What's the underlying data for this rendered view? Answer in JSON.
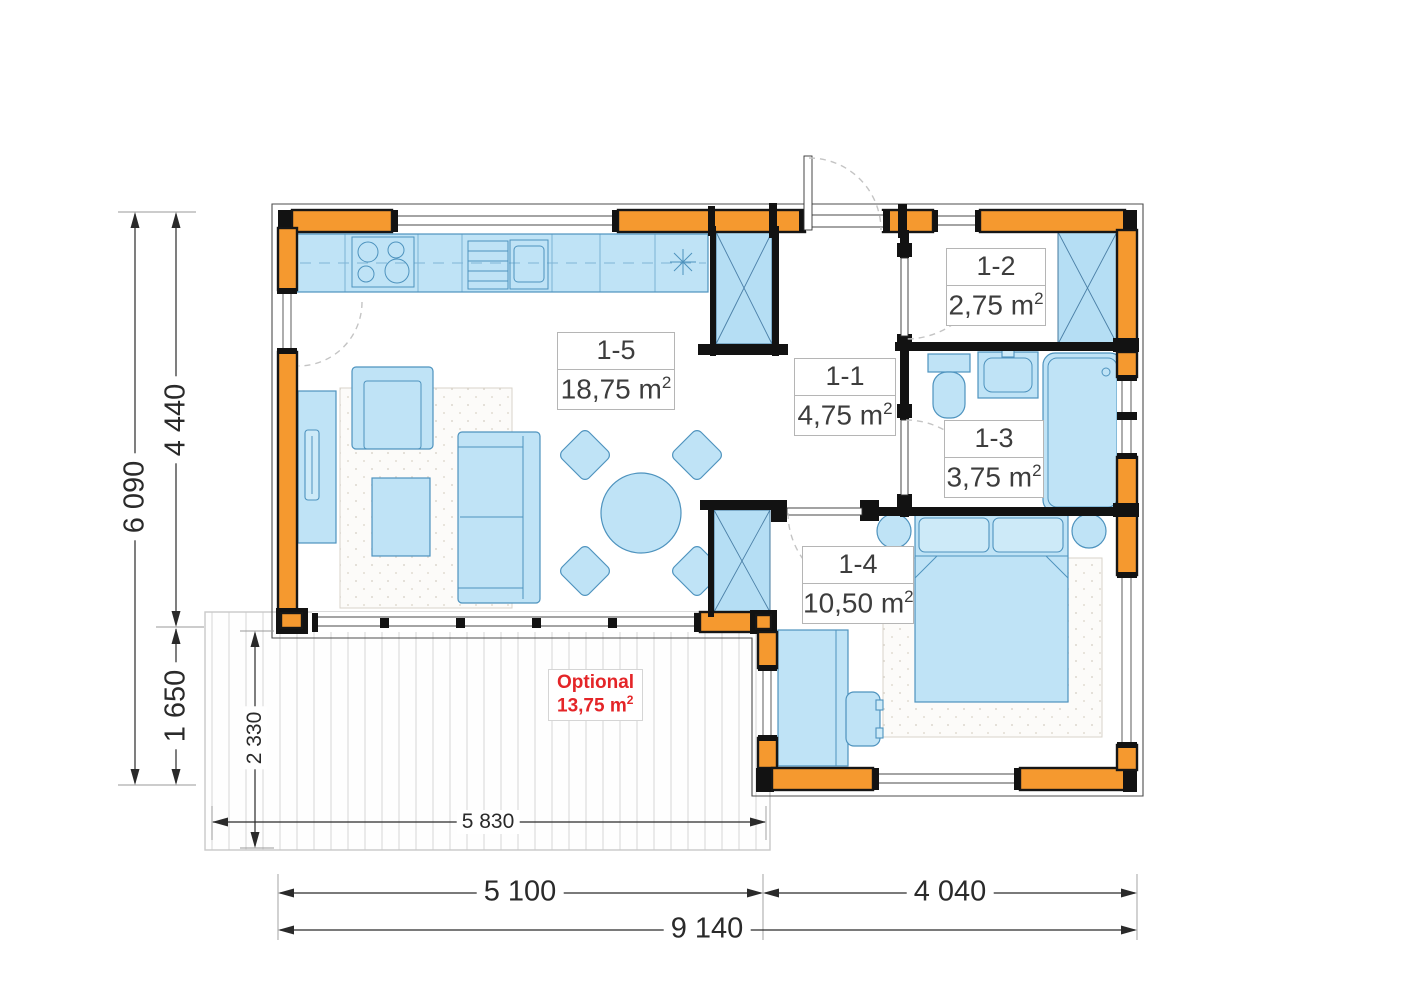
{
  "plan": {
    "rooms": [
      {
        "id": "1-5",
        "area_value": "18,75 m",
        "area_sup": "2"
      },
      {
        "id": "1-1",
        "area_value": "4,75 m",
        "area_sup": "2"
      },
      {
        "id": "1-2",
        "area_value": "2,75 m",
        "area_sup": "2"
      },
      {
        "id": "1-3",
        "area_value": "3,75 m",
        "area_sup": "2"
      },
      {
        "id": "1-4",
        "area_value": "10,50 m",
        "area_sup": "2"
      }
    ],
    "optional": {
      "label": "Optional",
      "area_value": "13,75 m",
      "area_sup": "2"
    },
    "dimensions": {
      "total_height": "6 090",
      "upper_height": "4 440",
      "lower_height": "1 650",
      "terrace_depth": "2 330",
      "terrace_width": "5 830",
      "living_width": "5 100",
      "bedroom_width": "4 040",
      "total_width": "9 140"
    },
    "colors": {
      "wall_fill": "#F5992F",
      "wall_stroke": "#161616",
      "furniture_fill": "#BFE3F6",
      "furniture_stroke": "#4E93BE",
      "optional_text": "#E42528",
      "label_text": "#3D3D3D",
      "dim_text": "#2A2A2A"
    }
  }
}
